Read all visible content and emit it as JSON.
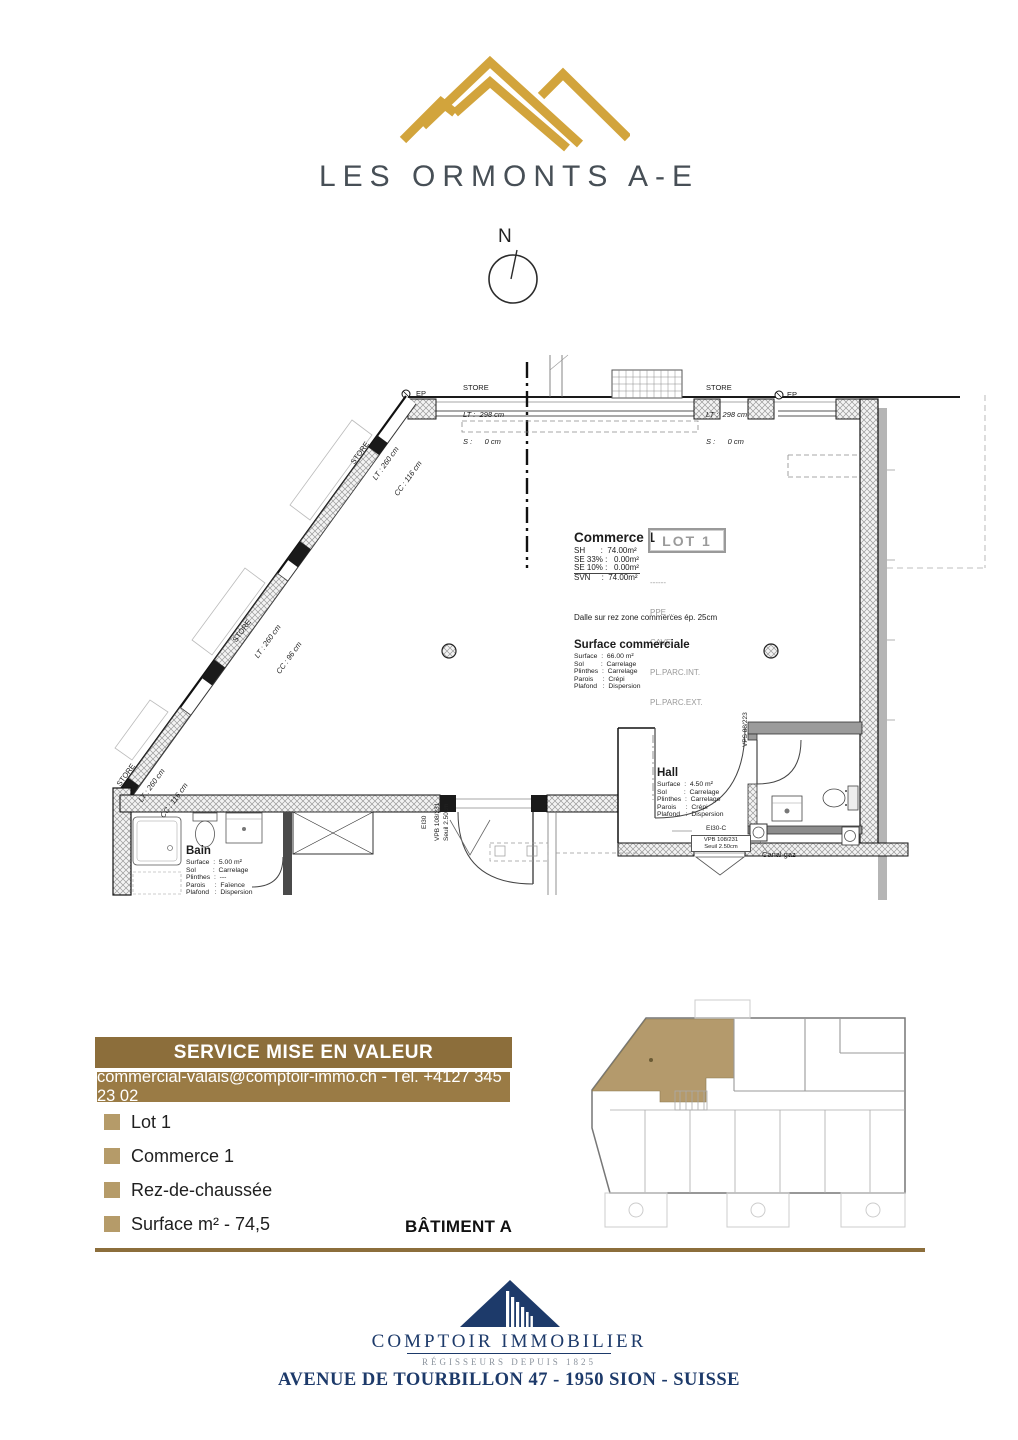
{
  "header": {
    "project_title": "LES ORMONTS A-E",
    "compass_n": "N"
  },
  "colors": {
    "gold": "#D2A43C",
    "banner_dark": "#8C6E3B",
    "banner_light": "#9A7B45",
    "bullet_tan": "#B59B69",
    "plan_highlight": "#B49A6C",
    "navy": "#1D3A6A",
    "wordmark_gray": "#474F56",
    "tagline_gray": "#8C949E"
  },
  "plan": {
    "ep": "EP",
    "store_top_left": {
      "title": "STORE",
      "lt": "LT :  298 cm",
      "s": "S :      0 cm"
    },
    "store_top_right": {
      "title": "STORE",
      "lt": "LT :  298 cm",
      "s": "S :      0 cm"
    },
    "store_diag_upper": {
      "title": "STORE",
      "lt": "LT : 260 cm",
      "cc": "CC : 116 cm"
    },
    "store_diag_middle": {
      "title": "STORE",
      "lt": "LT : 260 cm",
      "cc": "CC : 96 cm"
    },
    "store_diag_lower": {
      "title": "STORE",
      "lt": "LT : 260 cm",
      "cc": "CC : 116 cm"
    },
    "lot_badge": "LOT 1",
    "commerce": {
      "title": "Commerce 1",
      "rows": [
        "SH       :  74.00m²",
        "SE 33% :   0.00m²",
        "SE 10% :   0.00m²",
        "SVN     :  74.00m²"
      ]
    },
    "ownership": {
      "separator": "------",
      "lines": [
        "PPE ...",
        "CAVE ...",
        "PL.PARC.INT.",
        "PL.PARC.EXT."
      ]
    },
    "slab_note": "Dalle sur rez zone commerces ép. 25cm",
    "surface_commerciale": {
      "title": "Surface commerciale",
      "rows": [
        "Surface  :  66.00 m²",
        "Sol         :  Carrelage",
        "Plinthes  :  Carrelage",
        "Parois     :  Crépi",
        "Plafond   :  Dispersion"
      ]
    },
    "hall": {
      "title": "Hall",
      "rows": [
        "Surface  :  4.50 m²",
        "Sol         :  Carrelage",
        "Plinthes  :  Carrelage",
        "Parois     :  Crépi",
        "Plafond   :  Dispersion"
      ]
    },
    "bain": {
      "title": "Bain",
      "rows": [
        "Surface  :  5.00 m²",
        "Sol         :  Carrelage",
        "Plinthes  :  ---",
        "Parois     :  Faïence",
        "Plafond   :  Dispersion"
      ]
    },
    "main_door": {
      "fire": "EI30",
      "ref": "VPB 108/231",
      "sill": "Seuil 2.50cm"
    },
    "hall_door": {
      "fire": "EI30-C",
      "ref": "VPB 108/231",
      "sill": "Seuil 2.50cm"
    },
    "wc_window": "VPS 88/223",
    "canal_gaz": "Canal gaz"
  },
  "promo": {
    "banner_title": "SERVICE MISE EN VALEUR",
    "contact": "commercial-valais@comptoir-immo.ch - Tél. +4127 345 23 02",
    "items": [
      "Lot 1",
      "Commerce 1",
      "Rez-de-chaussée",
      "Surface m² - 74,5"
    ],
    "batiment": "BÂTIMENT A"
  },
  "footer": {
    "company": "COMPTOIR IMMOBILIER",
    "tagline": "RÉGISSEURS DEPUIS 1825",
    "address": "AVENUE DE TOURBILLON 47 - 1950 SION - SUISSE"
  }
}
